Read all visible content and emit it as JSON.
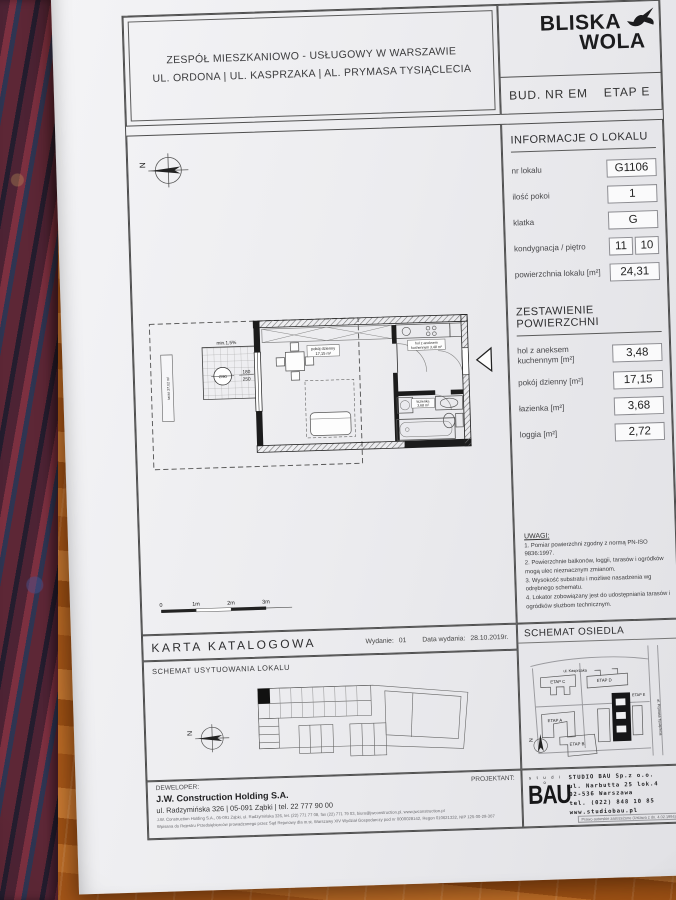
{
  "header": {
    "project_line1": "ZESPÓŁ MIESZKANIOWO - USŁUGOWY W WARSZAWIE",
    "project_line2": "UL. ORDONA | UL. KASPRZAKA | AL. PRYMASA TYSIĄCLECIA",
    "brand_line1": "BLISKA",
    "brand_line2": "WOLA",
    "building_label": "BUD. NR EM",
    "stage_label": "ETAP E"
  },
  "info": {
    "title": "INFORMACJE O LOKALU",
    "rows": [
      {
        "label": "nr lokalu",
        "value": "G1106"
      },
      {
        "label": "ilość pokoi",
        "value": "1"
      },
      {
        "label": "klatka",
        "value": "G"
      },
      {
        "label": "kondygnacja / piętro",
        "value": "11",
        "value2": "10"
      },
      {
        "label": "powierzchnia lokalu [m²]",
        "value": "24,31"
      }
    ]
  },
  "areas": {
    "title": "ZESTAWIENIE POWIERZCHNI",
    "rows": [
      {
        "label": "hol z aneksem kuchennym [m²]",
        "value": "3,48"
      },
      {
        "label": "pokój dzienny [m²]",
        "value": "17,15"
      },
      {
        "label": "łazienka [m²]",
        "value": "3,68"
      },
      {
        "label": "loggia [m²]",
        "value": "2,72"
      }
    ]
  },
  "uwagi": {
    "title": "UWAGI:",
    "items": [
      "1. Pomiar powierzchni zgodny z normą PN-ISO 9836:1997.",
      "2. Powierzchnie balkonów, loggii, tarasów i ogródków mogą ulec nieznacznym zmianom.",
      "3. Wysokość substratu i możliwe nasadzenia wg odrębnego schematu.",
      "4. Lokator zobowiązany jest do udostępniania tarasów i ogródków służbom technicznym."
    ]
  },
  "plan": {
    "slope_note": "min.1,5%",
    "drain_note": "∅90",
    "dim_width": "180",
    "dim_height": "250",
    "terrace_label": "taras 27,02 m²",
    "room_name": "pokój dzienny",
    "room_area": "17,15 m²",
    "hall_name": "hol z aneksem",
    "hall_name2": "kuchennym 3,48 m²",
    "bath_name": "łazienka",
    "bath_area": "3,68 m²",
    "north": "N",
    "scale_ticks": [
      "0",
      "1m",
      "2m",
      "3m"
    ]
  },
  "karta": {
    "title": "KARTA  KATALOGOWA",
    "issue_label": "Wydanie:",
    "issue_value": "01",
    "date_label": "Data wydania:",
    "date_value": "28.10.2019r."
  },
  "site_plan": {
    "title": "SCHEMAT USYTUOWANIA LOKALU",
    "north": "N"
  },
  "estate": {
    "title": "SCHEMAT OSIEDLA",
    "labels": [
      "ETAP C",
      "ETAP D",
      "ETAP A",
      "ETAP B",
      "ETAP E"
    ],
    "street_top": "ul. Kasprzaka",
    "street_right": "al. Prymasa Tysiąclecia",
    "north": "N"
  },
  "footer": {
    "developer_label": "DEWELOPER:",
    "developer_name": "J.W. Construction Holding S.A.",
    "developer_address": "ul. Radzymińska 326  |  05-091 Ząbki  |  tel. 22 777 90 00",
    "developer_fine1": "J.W. Construction Holding S.A., 05-091 Ząbki, ul. Radzymińska 326, tel. (22) 771 77 08, fax (22) 771 79 03, biuro@jwconstruction.pl, www.jwconstruction.pl",
    "developer_fine2": "Wpisana do Rejestru Przedsiębiorców prowadzonego przez Sąd Rejonowy dla m.st. Warszawy XIV Wydział Gospodarczy pod nr 0000028142, Regon 010621332, NIP 125-00-28-307",
    "architect_label": "PROJEKTANT:",
    "studio_logo_top": "s t u d i o",
    "studio_logo": "BAU",
    "studio_name": "STUDIO BAU Sp.z o.o.",
    "studio_address1": "ul. Narbutta 25 lok.4",
    "studio_address2": "02-536  Warszawa",
    "studio_phone": "tel. (022) 848 10 85",
    "studio_web": "www.studiobau.pl",
    "copyright": "Prawo autorskie zastrzeżone (Ustawa z dn. 4.02.1994)"
  }
}
